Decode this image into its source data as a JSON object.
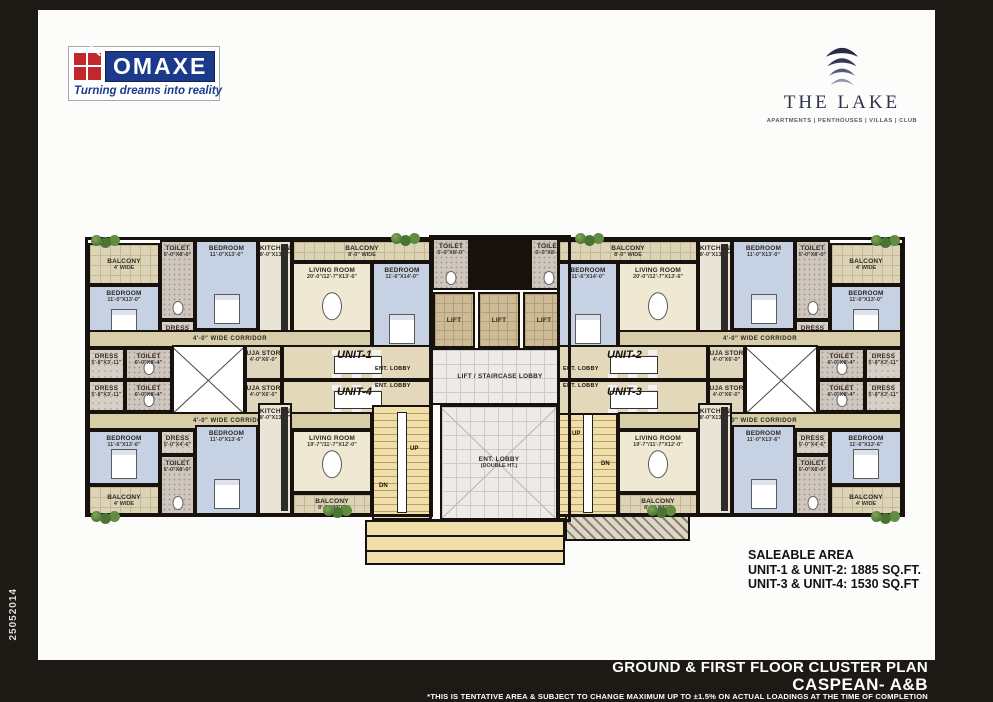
{
  "frame": {
    "side_code": "25052014"
  },
  "header": {
    "omaxe": {
      "name": "OMAXE",
      "tagline": "Turning dreams into reality",
      "brand_navy": "#1b3a8c",
      "brand_red": "#c1272d"
    },
    "lake": {
      "name": "THE LAKE",
      "categories": "APARTMENTS | PENTHOUSES | VILLAS | CLUB",
      "brand_navy": "#2e3350"
    }
  },
  "saleable": {
    "title": "SALEABLE AREA",
    "line1": "UNIT-1 & UNIT-2: 1885 SQ.FT.",
    "line2": "UNIT-3 & UNIT-4: 1530 SQ.FT"
  },
  "footer": {
    "title": "GROUND & FIRST FLOOR CLUSTER PLAN",
    "subtitle": "CASPEAN- A&B",
    "disclaimer": "*THIS IS TENTATIVE AREA & SUBJECT TO CHANGE MAXIMUM UP TO ±1.5% ON ACTUAL  LOADINGS AT THE TIME OF COMPLETION"
  },
  "plan": {
    "outlines": [
      {
        "name": "left-wing-outline",
        "x": 0,
        "y": 4,
        "w": 348,
        "h": 280
      },
      {
        "name": "center-core-outline",
        "x": 344,
        "y": 2,
        "w": 142,
        "h": 287
      },
      {
        "name": "right-wing-outline",
        "x": 472,
        "y": 4,
        "w": 348,
        "h": 280
      }
    ],
    "rooms": [
      {
        "name": "balcony-top-left",
        "type": "balcony",
        "label": "BALCONY",
        "dim": "4' WIDE",
        "x": 3,
        "y": 10,
        "w": 72,
        "h": 42
      },
      {
        "name": "bedroom-u1-left",
        "type": "bedroom",
        "label": "BEDROOM",
        "dim": "11'-0\"X13'-0\"",
        "x": 3,
        "y": 52,
        "w": 72,
        "h": 60
      },
      {
        "name": "toilet-u1",
        "type": "toilet",
        "label": "TOILET",
        "dim": "5'-0\"X8'-0\"",
        "x": 75,
        "y": 7,
        "w": 35,
        "h": 80
      },
      {
        "name": "dress-u1",
        "type": "dress",
        "label": "DRESS",
        "dim": "5'-0\"X4'-6\"",
        "x": 75,
        "y": 87,
        "w": 35,
        "h": 25
      },
      {
        "name": "bedroom-u1-mid",
        "type": "bedroom",
        "label": "BEDROOM",
        "dim": "11'-0\"X13'-0\"",
        "x": 110,
        "y": 7,
        "w": 63,
        "h": 90
      },
      {
        "name": "kitchen-u1",
        "type": "kitchen",
        "label": "KITCHEN",
        "dim": "8'-0\"X13'-0\"",
        "x": 173,
        "y": 7,
        "w": 34,
        "h": 105
      },
      {
        "name": "balcony-u1-living",
        "type": "balcony",
        "label": "BALCONY",
        "dim": "8'-0\" WIDE",
        "x": 207,
        "y": 7,
        "w": 140,
        "h": 22
      },
      {
        "name": "living-room-u1",
        "type": "living",
        "label": "LIVING ROOM",
        "dim": "20'-0\"/12'-7\"X13'-6\"",
        "x": 207,
        "y": 29,
        "w": 80,
        "h": 83
      },
      {
        "name": "bedroom-u1-center",
        "type": "bedroom",
        "label": "BEDROOM",
        "dim": "11'-6\"X14'-0\"",
        "x": 287,
        "y": 29,
        "w": 60,
        "h": 88
      },
      {
        "name": "corridor-u1",
        "type": "corridor",
        "label": "4'-0\" WIDE CORRIDOR",
        "x": 3,
        "y": 97,
        "w": 284,
        "h": 18
      },
      {
        "name": "dress-mid-left-a",
        "type": "dress",
        "label": "DRESS",
        "dim": "5'-8\"X3'-11\"",
        "x": 3,
        "y": 115,
        "w": 37,
        "h": 32
      },
      {
        "name": "toilet-mid-left-a",
        "type": "toilet",
        "label": "TOILET",
        "dim": "6'-0\"X8'-4\"",
        "x": 40,
        "y": 115,
        "w": 47,
        "h": 32
      },
      {
        "name": "shaft-left",
        "type": "core",
        "x": 87,
        "y": 112,
        "w": 73,
        "h": 70
      },
      {
        "name": "puja-store-u1",
        "type": "puja",
        "label": "PUJA STORE",
        "dim": "4'-0\"X6'-0\"",
        "x": 160,
        "y": 112,
        "w": 37,
        "h": 35
      },
      {
        "name": "puja-store-u4",
        "type": "puja",
        "label": "PUJA STORE",
        "dim": "4'-0\"X6'-0\"",
        "x": 160,
        "y": 147,
        "w": 37,
        "h": 35
      },
      {
        "name": "dining-u1",
        "type": "dining",
        "x": 197,
        "y": 112,
        "w": 150,
        "h": 35
      },
      {
        "name": "dining-u4",
        "type": "dining",
        "x": 197,
        "y": 147,
        "w": 150,
        "h": 35
      },
      {
        "name": "toilet-mid-left-b",
        "type": "toilet",
        "label": "TOILET",
        "dim": "6'-0\"X8'-4\"",
        "x": 40,
        "y": 147,
        "w": 47,
        "h": 32
      },
      {
        "name": "dress-mid-left-b",
        "type": "dress",
        "label": "DRESS",
        "dim": "5'-8\"X3'-11\"",
        "x": 3,
        "y": 147,
        "w": 37,
        "h": 32
      },
      {
        "name": "corridor-u4",
        "type": "corridor",
        "label": "4'-0\" WIDE CORRIDOR",
        "x": 3,
        "y": 179,
        "w": 284,
        "h": 18
      },
      {
        "name": "bedroom-u4-left",
        "type": "bedroom",
        "label": "BEDROOM",
        "dim": "11'-6\"X13'-6\"",
        "x": 3,
        "y": 197,
        "w": 72,
        "h": 55
      },
      {
        "name": "balcony-bottom-left",
        "type": "balcony",
        "label": "BALCONY",
        "dim": "4' WIDE",
        "x": 3,
        "y": 252,
        "w": 72,
        "h": 30
      },
      {
        "name": "dress-u4",
        "type": "dress",
        "label": "DRESS",
        "dim": "5'-0\"X4'-6\"",
        "x": 75,
        "y": 197,
        "w": 35,
        "h": 25
      },
      {
        "name": "toilet-u4",
        "type": "toilet",
        "label": "TOILET",
        "dim": "5'-0\"X8'-0\"",
        "x": 75,
        "y": 222,
        "w": 35,
        "h": 60
      },
      {
        "name": "bedroom-u4-mid",
        "type": "bedroom",
        "label": "BEDROOM",
        "dim": "11'-0\"X13'-6\"",
        "x": 110,
        "y": 192,
        "w": 63,
        "h": 90
      },
      {
        "name": "kitchen-u4",
        "type": "kitchen",
        "label": "KITCHEN",
        "dim": "8'-0\"X13'-0\"",
        "x": 173,
        "y": 170,
        "w": 34,
        "h": 112
      },
      {
        "name": "living-room-u4",
        "type": "living",
        "label": "LIVING ROOM",
        "dim": "19'-7\"/11'-7\"X12'-0\"",
        "x": 207,
        "y": 197,
        "w": 80,
        "h": 63
      },
      {
        "name": "balcony-u4-living",
        "type": "balcony",
        "label": "BALCONY",
        "dim": "8'-0\" WIDE",
        "x": 207,
        "y": 260,
        "w": 80,
        "h": 22
      },
      {
        "name": "staircase-left",
        "type": "stair",
        "x": 287,
        "y": 172,
        "w": 60,
        "h": 115
      },
      {
        "name": "toilet-center-left",
        "type": "toilet",
        "label": "TOILET",
        "dim": "5'-0\"X8'-0\"",
        "x": 347,
        "y": 5,
        "w": 38,
        "h": 52
      },
      {
        "name": "center-duct",
        "type": "void",
        "x": 385,
        "y": 5,
        "w": 60,
        "h": 52
      },
      {
        "name": "toilet-center-right",
        "type": "toilet",
        "label": "TOILET",
        "dim": "5'-0\"X8'-0\"",
        "x": 445,
        "y": 5,
        "w": 38,
        "h": 52
      },
      {
        "name": "lift-1",
        "type": "lift",
        "label": "LIFT",
        "x": 348,
        "y": 59,
        "w": 42,
        "h": 56
      },
      {
        "name": "lift-2",
        "type": "lift",
        "label": "LIFT",
        "x": 393,
        "y": 59,
        "w": 42,
        "h": 56
      },
      {
        "name": "lift-3",
        "type": "lift",
        "label": "LIFT",
        "x": 438,
        "y": 59,
        "w": 42,
        "h": 56
      },
      {
        "name": "lift-staircase-lobby",
        "type": "lobby",
        "label": "LIFT / STAIRCASE LOBBY",
        "x": 345,
        "y": 115,
        "w": 140,
        "h": 57
      },
      {
        "name": "entrance-lobby-double-height",
        "type": "lobby2",
        "label": "ENT. LOBBY",
        "dim": "(DOUBLE HT.)",
        "x": 355,
        "y": 172,
        "w": 118,
        "h": 115
      },
      {
        "name": "staircase-right",
        "type": "stair",
        "x": 473,
        "y": 172,
        "w": 60,
        "h": 115
      },
      {
        "name": "entrance-steps",
        "type": "porch",
        "x": 280,
        "y": 287,
        "w": 200,
        "h": 45
      },
      {
        "name": "ramp-hatch",
        "type": "hatch",
        "x": 480,
        "y": 282,
        "w": 125,
        "h": 26
      },
      {
        "name": "balcony-u2-living",
        "type": "balcony",
        "label": "BALCONY",
        "dim": "8'-0\" WIDE",
        "x": 473,
        "y": 7,
        "w": 140,
        "h": 22
      },
      {
        "name": "bedroom-u2-center",
        "type": "bedroom",
        "label": "BEDROOM",
        "dim": "11'-6\"X14'-0\"",
        "x": 473,
        "y": 29,
        "w": 60,
        "h": 88
      },
      {
        "name": "living-room-u2",
        "type": "living",
        "label": "LIVING ROOM",
        "dim": "20'-0\"/12'-7\"X13'-6\"",
        "x": 533,
        "y": 29,
        "w": 80,
        "h": 83
      },
      {
        "name": "kitchen-u2",
        "type": "kitchen",
        "label": "KITCHEN",
        "dim": "8'-0\"X13'-0\"",
        "x": 613,
        "y": 7,
        "w": 34,
        "h": 105
      },
      {
        "name": "bedroom-u2-mid",
        "type": "bedroom",
        "label": "BEDROOM",
        "dim": "11'-0\"X13'-0\"",
        "x": 647,
        "y": 7,
        "w": 63,
        "h": 90
      },
      {
        "name": "toilet-u2",
        "type": "toilet",
        "label": "TOILET",
        "dim": "5'-0\"X8'-0\"",
        "x": 710,
        "y": 7,
        "w": 35,
        "h": 80
      },
      {
        "name": "dress-u2",
        "type": "dress",
        "label": "DRESS",
        "dim": "5'-0\"X4'-6\"",
        "x": 710,
        "y": 87,
        "w": 35,
        "h": 25
      },
      {
        "name": "balcony-top-right",
        "type": "balcony",
        "label": "BALCONY",
        "dim": "4' WIDE",
        "x": 745,
        "y": 10,
        "w": 72,
        "h": 42
      },
      {
        "name": "bedroom-u2-right",
        "type": "bedroom",
        "label": "BEDROOM",
        "dim": "11'-0\"X13'-0\"",
        "x": 745,
        "y": 52,
        "w": 72,
        "h": 60
      },
      {
        "name": "corridor-u2",
        "type": "corridor",
        "label": "4'-0\" WIDE CORRIDOR",
        "x": 533,
        "y": 97,
        "w": 284,
        "h": 18
      },
      {
        "name": "dining-u2",
        "type": "dining",
        "x": 473,
        "y": 112,
        "w": 150,
        "h": 35
      },
      {
        "name": "dining-u3",
        "type": "dining",
        "x": 473,
        "y": 147,
        "w": 150,
        "h": 35
      },
      {
        "name": "puja-store-u2",
        "type": "puja",
        "label": "PUJA STORE",
        "dim": "4'-0\"X6'-0\"",
        "x": 623,
        "y": 112,
        "w": 37,
        "h": 35
      },
      {
        "name": "puja-store-u3",
        "type": "puja",
        "label": "PUJA STORE",
        "dim": "4'-0\"X6'-0\"",
        "x": 623,
        "y": 147,
        "w": 37,
        "h": 35
      },
      {
        "name": "shaft-right",
        "type": "core",
        "x": 660,
        "y": 112,
        "w": 73,
        "h": 70
      },
      {
        "name": "toilet-mid-right-a",
        "type": "toilet",
        "label": "TOILET",
        "dim": "6'-0\"X8'-4\"",
        "x": 733,
        "y": 115,
        "w": 47,
        "h": 32
      },
      {
        "name": "dress-mid-right-a",
        "type": "dress",
        "label": "DRESS",
        "dim": "5'-8\"X3'-11\"",
        "x": 780,
        "y": 115,
        "w": 37,
        "h": 32
      },
      {
        "name": "toilet-mid-right-b",
        "type": "toilet",
        "label": "TOILET",
        "dim": "6'-0\"X8'-4\"",
        "x": 733,
        "y": 147,
        "w": 47,
        "h": 32
      },
      {
        "name": "dress-mid-right-b",
        "type": "dress",
        "label": "DRESS",
        "dim": "5'-8\"X3'-11\"",
        "x": 780,
        "y": 147,
        "w": 37,
        "h": 32
      },
      {
        "name": "corridor-u3",
        "type": "corridor",
        "label": "4'-0\" WIDE CORRIDOR",
        "x": 533,
        "y": 179,
        "w": 284,
        "h": 18
      },
      {
        "name": "living-room-u3",
        "type": "living",
        "label": "LIVING ROOM",
        "dim": "19'-7\"/11'-7\"X12'-0\"",
        "x": 533,
        "y": 197,
        "w": 80,
        "h": 63
      },
      {
        "name": "balcony-u3-living",
        "type": "balcony",
        "label": "BALCONY",
        "dim": "8'-0\" WIDE",
        "x": 533,
        "y": 260,
        "w": 80,
        "h": 22
      },
      {
        "name": "kitchen-u3",
        "type": "kitchen",
        "label": "KITCHEN",
        "dim": "8'-0\"X13'-0\"",
        "x": 613,
        "y": 170,
        "w": 34,
        "h": 112
      },
      {
        "name": "bedroom-u3-mid",
        "type": "bedroom",
        "label": "BEDROOM",
        "dim": "11'-0\"X13'-6\"",
        "x": 647,
        "y": 192,
        "w": 63,
        "h": 90
      },
      {
        "name": "dress-u3",
        "type": "dress",
        "label": "DRESS",
        "dim": "5'-0\"X4'-6\"",
        "x": 710,
        "y": 197,
        "w": 35,
        "h": 25
      },
      {
        "name": "toilet-u3",
        "type": "toilet",
        "label": "TOILET",
        "dim": "5'-0\"X8'-0\"",
        "x": 710,
        "y": 222,
        "w": 35,
        "h": 60
      },
      {
        "name": "bedroom-u3-right",
        "type": "bedroom",
        "label": "BEDROOM",
        "dim": "11'-6\"X13'-6\"",
        "x": 745,
        "y": 197,
        "w": 72,
        "h": 55
      },
      {
        "name": "balcony-bottom-right",
        "type": "balcony",
        "label": "BALCONY",
        "dim": "4' WIDE",
        "x": 745,
        "y": 252,
        "w": 72,
        "h": 30
      }
    ],
    "annotations": [
      {
        "name": "unit-1-label",
        "text": "UNIT-1",
        "cls": "unit",
        "x": 252,
        "y": 116
      },
      {
        "name": "unit-4-label",
        "text": "UNIT-4",
        "cls": "unit",
        "x": 252,
        "y": 153
      },
      {
        "name": "unit-2-label",
        "text": "UNIT-2",
        "cls": "unit",
        "x": 522,
        "y": 116
      },
      {
        "name": "unit-3-label",
        "text": "UNIT-3",
        "cls": "unit",
        "x": 522,
        "y": 153
      },
      {
        "name": "ent-lobby-u1",
        "text": "ENT. LOBBY",
        "cls": "tiny",
        "x": 290,
        "y": 133
      },
      {
        "name": "ent-lobby-u4",
        "text": "ENT. LOBBY",
        "cls": "tiny",
        "x": 290,
        "y": 150
      },
      {
        "name": "ent-lobby-u2",
        "text": "ENT. LOBBY",
        "cls": "tiny",
        "x": 478,
        "y": 133
      },
      {
        "name": "ent-lobby-u3",
        "text": "ENT. LOBBY",
        "cls": "tiny",
        "x": 478,
        "y": 150
      },
      {
        "name": "stair-up-left",
        "text": "UP",
        "cls": "stair-lbl",
        "x": 325,
        "y": 213
      },
      {
        "name": "stair-dn-left",
        "text": "DN",
        "cls": "stair-lbl",
        "x": 294,
        "y": 250
      },
      {
        "name": "stair-up-right",
        "text": "UP",
        "cls": "stair-lbl",
        "x": 487,
        "y": 198
      },
      {
        "name": "stair-dn-right",
        "text": "DN",
        "cls": "stair-lbl",
        "x": 516,
        "y": 228
      }
    ],
    "plants": [
      {
        "x": 6,
        "y": 2
      },
      {
        "x": 306,
        "y": 0
      },
      {
        "x": 490,
        "y": 0
      },
      {
        "x": 786,
        "y": 2
      },
      {
        "x": 6,
        "y": 278
      },
      {
        "x": 238,
        "y": 272
      },
      {
        "x": 562,
        "y": 272
      },
      {
        "x": 786,
        "y": 278
      }
    ]
  }
}
